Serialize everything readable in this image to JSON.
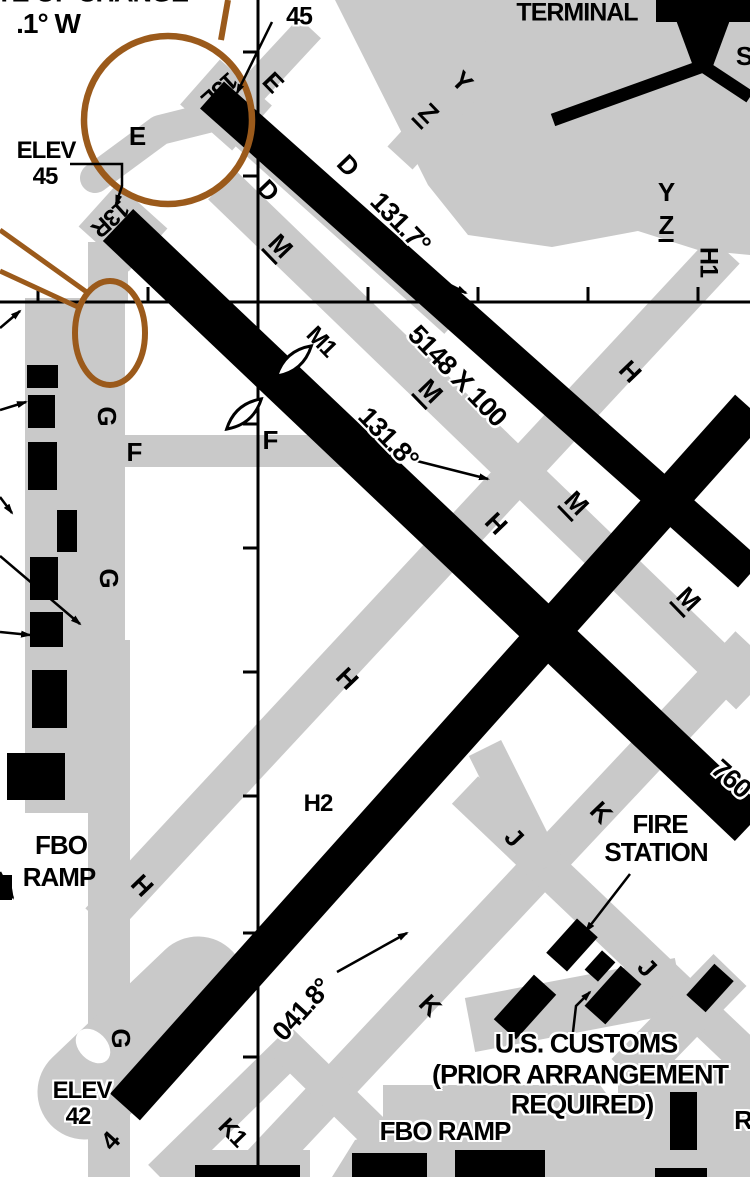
{
  "colors": {
    "taxiway_apron_gray": "#c9c9c9",
    "runway_black": "#000000",
    "highlight_brown": "#9b5a1b",
    "background_white": "#ffffff"
  },
  "airport_summary": {
    "runways": [
      {
        "id": "13L",
        "heading": "131.7°",
        "dimensions": "5148 X 100",
        "threshold_elevation": "45"
      },
      {
        "id": "13R",
        "heading": "131.8°",
        "threshold_elevation": "45",
        "dimension_fragment_visible": "760"
      },
      {
        "id": "4",
        "heading": "041.8°",
        "threshold_elevation": "42"
      }
    ],
    "taxiways_visible": [
      "E",
      "D",
      "M",
      "M1",
      "Y",
      "Z",
      "H",
      "H1",
      "H2",
      "F",
      "G",
      "K",
      "K1",
      "J"
    ],
    "facilities": [
      "TERMINAL",
      "FIRE STATION",
      "U.S. CUSTOMS (PRIOR ARRANGEMENT REQUIRED)",
      "FBO RAMP"
    ],
    "note_fragments": [
      "TE OF CHANGE",
      ".1° W",
      "S",
      "R"
    ]
  },
  "labels": [
    {
      "t": "TE OF CHANGE",
      "x": 92,
      "y": -7,
      "r": 0,
      "s": 27,
      "h": 1
    },
    {
      "t": ".1° W",
      "x": 48,
      "y": 24,
      "r": 0,
      "s": 28,
      "h": 1
    },
    {
      "t": "ELEV",
      "x": 295,
      "y": -8,
      "r": 0,
      "s": 23,
      "h": 1
    },
    {
      "t": "45",
      "x": 299,
      "y": 17,
      "r": 0,
      "s": 25,
      "h": 1
    },
    {
      "t": "ELEV",
      "x": 46,
      "y": 151,
      "r": 0,
      "s": 24,
      "h": 1
    },
    {
      "t": "45",
      "x": 45,
      "y": 177,
      "r": 0,
      "s": 24,
      "h": 1
    },
    {
      "t": "ELEV",
      "x": 82,
      "y": 1091,
      "r": 0,
      "s": 24,
      "h": 1
    },
    {
      "t": "42",
      "x": 78,
      "y": 1117,
      "r": 0,
      "s": 24,
      "h": 1
    },
    {
      "t": "TERMINAL",
      "x": 577,
      "y": 13,
      "r": 0,
      "s": 25,
      "h": 0
    },
    {
      "t": "S",
      "x": 744,
      "y": 56,
      "r": 0,
      "s": 26,
      "h": 0
    },
    {
      "t": "13L",
      "x": 219,
      "y": 89,
      "r": 138,
      "s": 24,
      "h": 0
    },
    {
      "t": "13R",
      "x": 110,
      "y": 218,
      "r": 138,
      "s": 24,
      "h": 0
    },
    {
      "t": "4",
      "x": 110,
      "y": 1141,
      "r": -48,
      "s": 26,
      "h": 0
    },
    {
      "t": "131.7°",
      "x": 400,
      "y": 223,
      "r": 46,
      "s": 27,
      "h": 1
    },
    {
      "t": "5148 X 100",
      "x": 457,
      "y": 376,
      "r": 46,
      "s": 27,
      "h": 1
    },
    {
      "t": "131.8°",
      "x": 388,
      "y": 438,
      "r": 46,
      "s": 27,
      "h": 1
    },
    {
      "t": "041.8°",
      "x": 302,
      "y": 1010,
      "r": -48,
      "s": 27,
      "h": 1
    },
    {
      "t": "760",
      "x": 731,
      "y": 779,
      "r": 42,
      "s": 27,
      "h": 1
    },
    {
      "t": "E",
      "x": 137,
      "y": 136,
      "r": 0,
      "s": 26
    },
    {
      "t": "E",
      "x": 273,
      "y": 82,
      "r": 46,
      "s": 26
    },
    {
      "t": "D",
      "x": 348,
      "y": 165,
      "r": 46,
      "s": 26
    },
    {
      "t": "D",
      "x": 268,
      "y": 190,
      "r": 46,
      "s": 26
    },
    {
      "t": "M",
      "x": 279,
      "y": 247,
      "r": 46,
      "s": 26,
      "u": 1
    },
    {
      "t": "Y",
      "x": 462,
      "y": 81,
      "r": 46,
      "s": 26
    },
    {
      "t": "Z",
      "x": 427,
      "y": 114,
      "r": 46,
      "s": 26,
      "u": 1
    },
    {
      "t": "Y",
      "x": 666,
      "y": 192,
      "r": 0,
      "s": 26
    },
    {
      "t": "Z",
      "x": 666,
      "y": 227,
      "r": 0,
      "s": 26,
      "u": 1
    },
    {
      "t": "H1",
      "x": 708,
      "y": 262,
      "r": 90,
      "s": 25
    },
    {
      "t": "M",
      "x": 429,
      "y": 392,
      "r": 46,
      "s": 26,
      "u": 1
    },
    {
      "t": "M",
      "x": 575,
      "y": 504,
      "r": 46,
      "s": 26,
      "u": 1
    },
    {
      "t": "M",
      "x": 687,
      "y": 600,
      "r": 46,
      "s": 26,
      "u": 1
    },
    {
      "t": "M1",
      "x": 321,
      "y": 342,
      "r": 46,
      "s": 24
    },
    {
      "t": "H",
      "x": 630,
      "y": 371,
      "r": 46,
      "s": 26
    },
    {
      "t": "H",
      "x": 496,
      "y": 523,
      "r": 46,
      "s": 26
    },
    {
      "t": "H",
      "x": 347,
      "y": 678,
      "r": 46,
      "s": 26
    },
    {
      "t": "H",
      "x": 142,
      "y": 885,
      "r": 46,
      "s": 26
    },
    {
      "t": "H2",
      "x": 318,
      "y": 804,
      "r": 0,
      "s": 24
    },
    {
      "t": "F",
      "x": 270,
      "y": 440,
      "r": 0,
      "s": 26
    },
    {
      "t": "F",
      "x": 134,
      "y": 452,
      "r": 0,
      "s": 26
    },
    {
      "t": "G",
      "x": 107,
      "y": 416,
      "r": 90,
      "s": 26
    },
    {
      "t": "G",
      "x": 109,
      "y": 578,
      "r": 90,
      "s": 26
    },
    {
      "t": "G",
      "x": 121,
      "y": 1038,
      "r": 90,
      "s": 26
    },
    {
      "t": "K",
      "x": 601,
      "y": 812,
      "r": 46,
      "s": 26
    },
    {
      "t": "K",
      "x": 430,
      "y": 1005,
      "r": 46,
      "s": 26
    },
    {
      "t": "J",
      "x": 514,
      "y": 837,
      "r": 46,
      "s": 26
    },
    {
      "t": "J",
      "x": 647,
      "y": 967,
      "r": 46,
      "s": 26
    },
    {
      "t": "K1",
      "x": 232,
      "y": 1133,
      "r": 46,
      "s": 24
    },
    {
      "t": "FIRE",
      "x": 660,
      "y": 824,
      "r": 0,
      "s": 26,
      "h": 1
    },
    {
      "t": "STATION",
      "x": 656,
      "y": 852,
      "r": 0,
      "s": 26,
      "h": 1
    },
    {
      "t": "U.S. CUSTOMS",
      "x": 586,
      "y": 1044,
      "r": 0,
      "s": 27,
      "h": 1
    },
    {
      "t": "(PRIOR ARRANGEMENT",
      "x": 580,
      "y": 1075,
      "r": 0,
      "s": 27,
      "h": 1
    },
    {
      "t": "REQUIRED)",
      "x": 582,
      "y": 1105,
      "r": 0,
      "s": 27,
      "h": 1
    },
    {
      "t": "FBO",
      "x": 61,
      "y": 845,
      "r": 0,
      "s": 26,
      "h": 0
    },
    {
      "t": "RAMP",
      "x": 59,
      "y": 877,
      "r": 0,
      "s": 26,
      "h": 0
    },
    {
      "t": "FBO RAMP",
      "x": 445,
      "y": 1131,
      "r": 0,
      "s": 26,
      "h": 1
    },
    {
      "t": "R",
      "x": 743,
      "y": 1120,
      "r": 0,
      "s": 26,
      "h": 1
    }
  ]
}
